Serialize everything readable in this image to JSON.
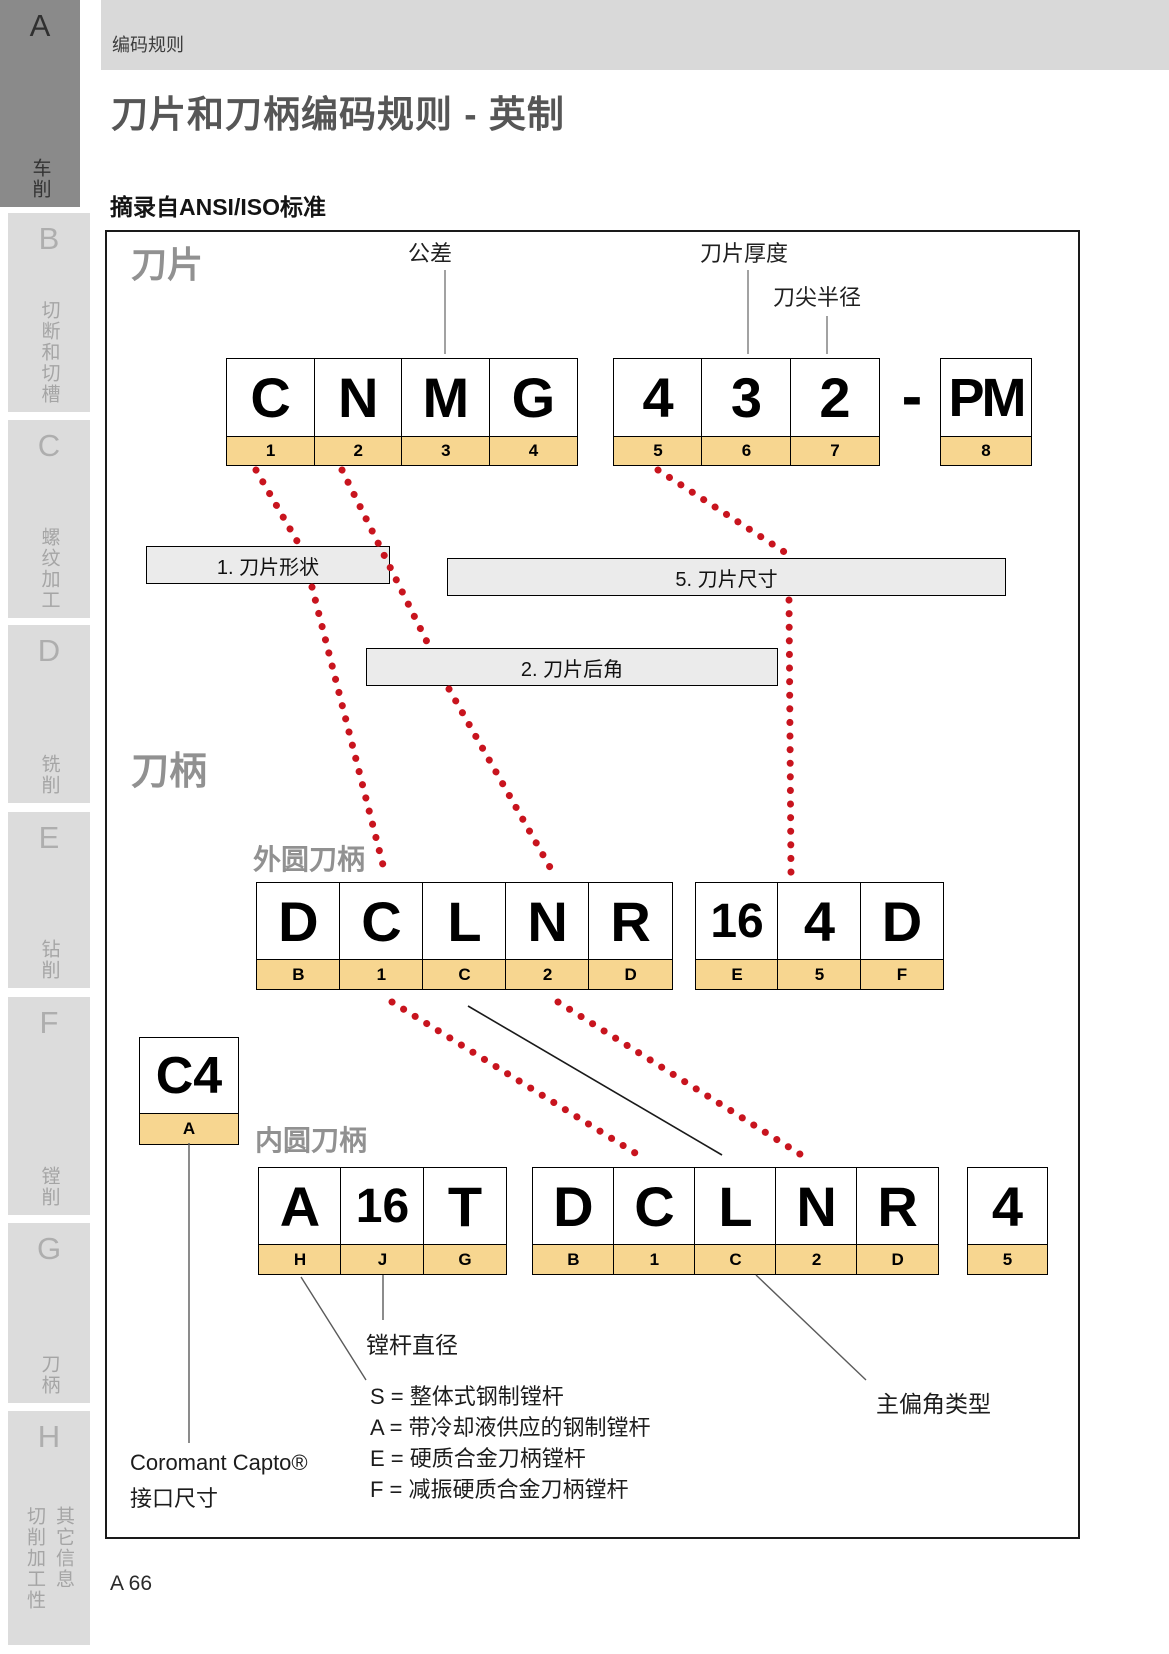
{
  "sidebar": {
    "items": [
      {
        "letter": "A",
        "label": "车削",
        "active": true
      },
      {
        "letter": "B",
        "label": "切断和切槽",
        "active": false
      },
      {
        "letter": "C",
        "label": "螺纹加工",
        "active": false
      },
      {
        "letter": "D",
        "label": "铣削",
        "active": false
      },
      {
        "letter": "E",
        "label": "钻削",
        "active": false
      },
      {
        "letter": "F",
        "label": "镗削",
        "active": false
      },
      {
        "letter": "G",
        "label": "刀柄",
        "active": false
      },
      {
        "letter": "H",
        "label": "切削加工性",
        "label2": "其它信息",
        "active": false
      }
    ]
  },
  "header": {
    "breadcrumb": "编码规则",
    "title": "刀片和刀柄编码规则 - 英制",
    "subtitle": "摘录自ANSI/ISO标准"
  },
  "diagram": {
    "insert_section_label": "刀片",
    "holder_section_label": "刀柄",
    "external_label": "外圆刀柄",
    "internal_label": "内圆刀柄",
    "pointers": {
      "tolerance": "公差",
      "thickness": "刀片厚度",
      "nose_radius": "刀尖半径"
    },
    "insert_code": {
      "group1": {
        "chars": [
          "C",
          "N",
          "M",
          "G"
        ],
        "tabs": [
          "1",
          "2",
          "3",
          "4"
        ]
      },
      "group2": {
        "chars": [
          "4",
          "3",
          "2"
        ],
        "tabs": [
          "5",
          "6",
          "7"
        ]
      },
      "separator": "-",
      "group3": {
        "chars": [
          "PM"
        ],
        "tabs": [
          "8"
        ]
      }
    },
    "callouts": {
      "shape": "1. 刀片形状",
      "size": "5. 刀片尺寸",
      "clearance": "2. 刀片后角"
    },
    "external_code": {
      "group1": {
        "chars": [
          "D",
          "C",
          "L",
          "N",
          "R"
        ],
        "tabs": [
          "B",
          "1",
          "C",
          "2",
          "D"
        ]
      },
      "group2": {
        "chars": [
          "16",
          "4",
          "D"
        ],
        "tabs": [
          "E",
          "5",
          "F"
        ]
      }
    },
    "capto_code": {
      "chars": [
        "C4"
      ],
      "tabs": [
        "A"
      ]
    },
    "internal_code": {
      "group1": {
        "chars": [
          "A",
          "16",
          "T"
        ],
        "tabs": [
          "H",
          "J",
          "G"
        ]
      },
      "group2": {
        "chars": [
          "D",
          "C",
          "L",
          "N",
          "R"
        ],
        "tabs": [
          "B",
          "1",
          "C",
          "2",
          "D"
        ]
      },
      "group3": {
        "chars": [
          "4"
        ],
        "tabs": [
          "5"
        ]
      }
    },
    "annotations": {
      "bar_diameter": "镗杆直径",
      "entering_angle": "主偏角类型",
      "capto_line1": "Coromant Capto®",
      "capto_line2": "接口尺寸",
      "legend": [
        "S = 整体式钢制镗杆",
        "A = 带冷却液供应的钢制镗杆",
        "E = 硬质合金刀柄镗杆",
        "F = 减振硬质合金刀柄镗杆"
      ]
    }
  },
  "footer": {
    "page_number": "A 66"
  },
  "colors": {
    "tab_fill": "#f7d690",
    "dotted_line": "#c8141e",
    "header_band": "#d9d9d9",
    "active_tab": "#8a8a8a"
  }
}
